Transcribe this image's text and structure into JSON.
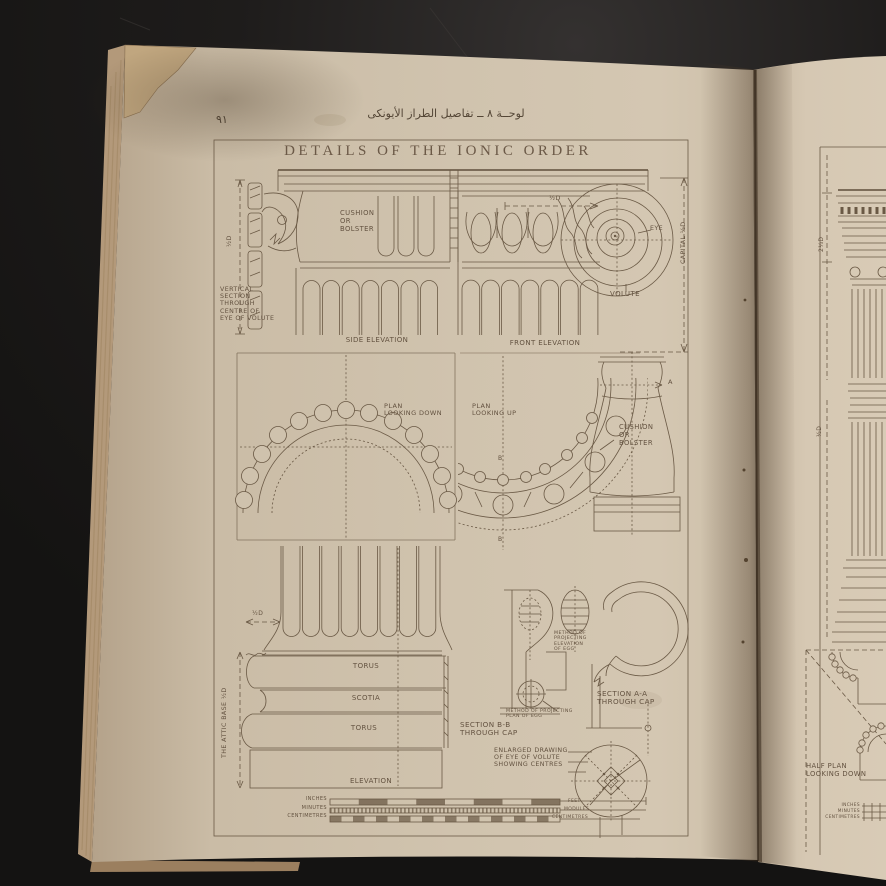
{
  "photo": {
    "page_number": "٩١",
    "arabic_caption": "لوحــة ٨ ــ تفاصيل الطراز الأيونكى",
    "plate_title": "DETAILS OF THE IONIC ORDER"
  },
  "labels": {
    "half_d": "½D",
    "vertical_section": "VERTICAL\nSECTION\nTHROUGH\nCENTRE OF\nEYE OF VOLUTE",
    "cushion": "CUSHION\nOR\nBOLSTER",
    "side_elevation": "SIDE  ELEVATION",
    "front_elevation": "FRONT  ELEVATION",
    "eye": "EYE",
    "volute": "VOLUTE",
    "capital_half_d": "CAPITAL ½D",
    "plan_down": "PLAN\nLOOKING  DOWN",
    "plan_up": "PLAN\nLOOKING  UP",
    "marker_a": "A",
    "marker_b": "B",
    "torus": "TORUS",
    "scotia": "SCOTIA",
    "attic_base": "THE ATTIC BASE ½D",
    "elevation": "ELEVATION",
    "section_bb": "SECTION  B-B\nTHROUGH  CAP",
    "section_aa": "SECTION  A-A\nTHROUGH  CAP",
    "method_elevation_egg": "METHOD OF\nPROJECTING\nELEVATION\nOF EGG",
    "method_plan_egg": "METHOD OF PROJECTING\nPLAN OF EGG",
    "enlarged_eye": "ENLARGED  DRAWING\nOF  EYE  OF  VOLUTE\nSHOWING  CENTRES"
  },
  "scales": {
    "inches": "INCHES",
    "minutes": "MINUTES",
    "centimetres": "CENTIMETRES",
    "feet": "FEET",
    "modules": "MODULES"
  },
  "right_page": {
    "dim_entablature": "2⅓D",
    "dim_capital": "½D",
    "half_plan": "HALF  PLAN\nLOOKING  DOWN"
  },
  "colors": {
    "background": "#1a1817",
    "left_page": "#cfc2ad",
    "right_page": "#d6c8b3",
    "page_edges": "#b3997a",
    "ink": "#6a5945"
  }
}
